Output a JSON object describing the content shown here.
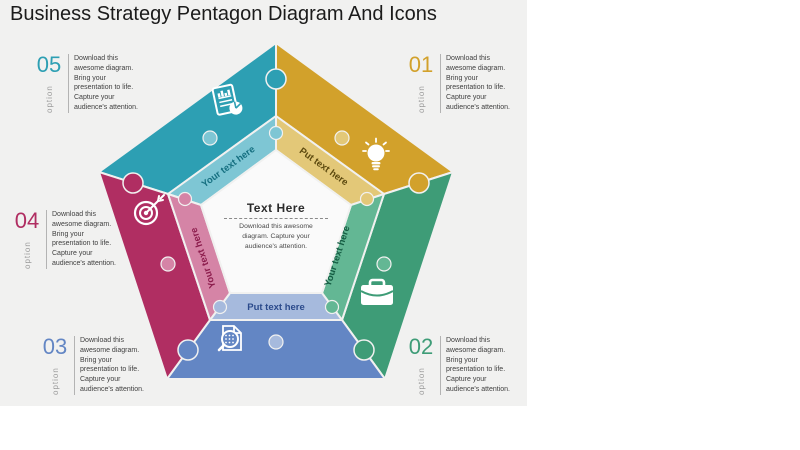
{
  "title": "Business Strategy Pentagon Diagram And Icons",
  "colors": {
    "canvas_bg": "#ffffff",
    "slide_bg": "#f1f1f0",
    "title_color": "#1b1b1b",
    "option_label_color": "#9b9b9b"
  },
  "options": [
    {
      "id": "01",
      "label": "option",
      "color": "#D2A12B",
      "text": "Download this\nawesome diagram.\nBring your\npresentation to life.\nCapture your\naudience's attention."
    },
    {
      "id": "02",
      "label": "option",
      "color": "#3E9C77",
      "text": "Download this\nawesome diagram.\nBring your\npresentation to life.\nCapture your\naudience's attention."
    },
    {
      "id": "03",
      "label": "option",
      "color": "#6386C4",
      "text": "Download this\nawesome diagram.\nBring your\npresentation to life.\nCapture your\naudience's attention."
    },
    {
      "id": "04",
      "label": "option",
      "color": "#B02E62",
      "text": "Download this\nawesome diagram.\nBring your\npresentation to life.\nCapture your\naudience's attention."
    },
    {
      "id": "05",
      "label": "option",
      "color": "#2D9FB3",
      "text": "Download this\nawesome diagram.\nBring your\npresentation to life.\nCapture your\naudience's attention."
    }
  ],
  "center": {
    "title": "Text Here",
    "text": "Download this awesome\ndiagram. Capture your\naudience's attention."
  },
  "pieces": [
    {
      "position": "top-left-edge",
      "icon": "report-chart-icon",
      "color": "#2D9FB3",
      "light_color": "#7EC6D4",
      "text_color": "#156F80",
      "label": "Your text here"
    },
    {
      "position": "top-right-edge",
      "icon": "lightbulb-icon",
      "color": "#D2A12B",
      "light_color": "#E3C878",
      "text_color": "#5D4A0F",
      "label": "Put text here"
    },
    {
      "position": "right-edge",
      "icon": "briefcase-icon",
      "color": "#3E9C77",
      "light_color": "#63B794",
      "text_color": "#145C42",
      "label": "Your text here"
    },
    {
      "position": "bottom-edge",
      "icon": "search-document-icon",
      "color": "#6386C4",
      "light_color": "#A6BADD",
      "text_color": "#2B4A8B",
      "label": "Put text here"
    },
    {
      "position": "left-edge",
      "icon": "target-icon",
      "color": "#B02E62",
      "light_color": "#D584A6",
      "text_color": "#8C1C4C",
      "label": "Your text here"
    }
  ]
}
